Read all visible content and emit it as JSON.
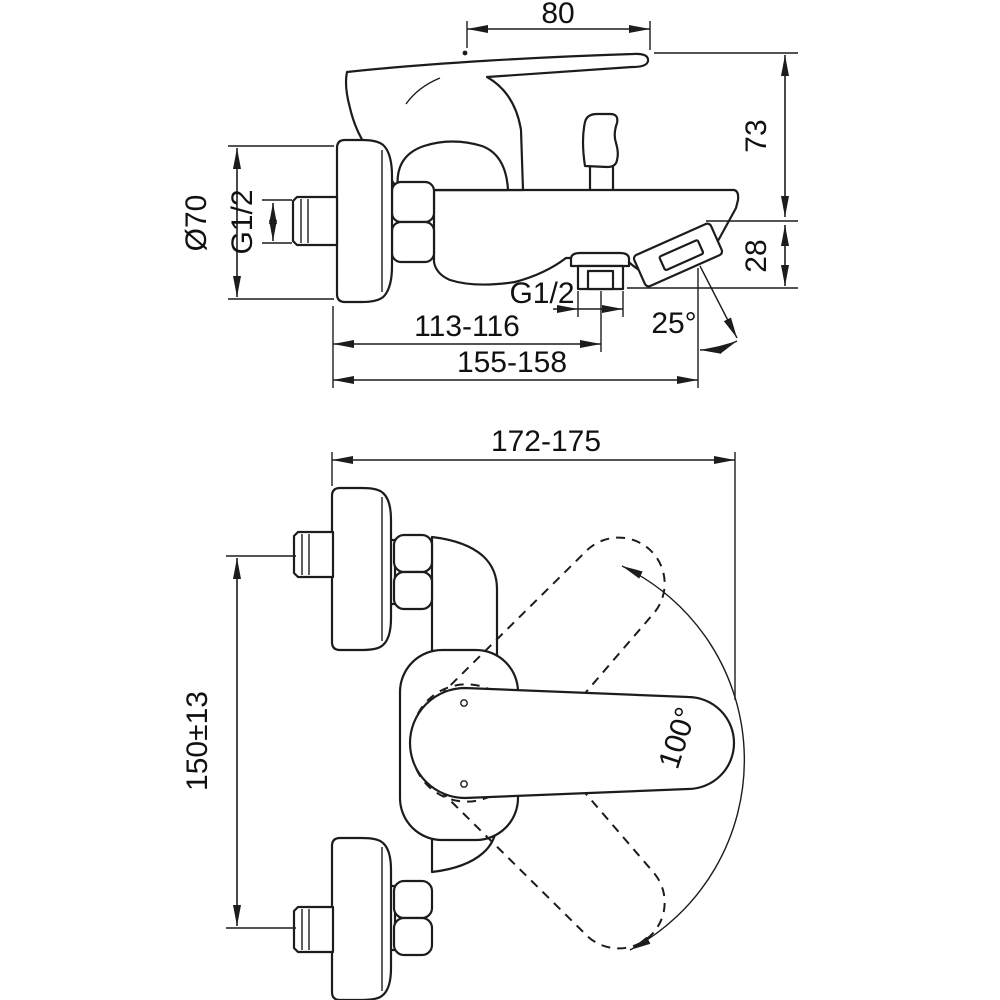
{
  "dimensions": {
    "lever_length": "80",
    "height_to_lever": "73",
    "spout_height": "28",
    "flange_diameter": "Ø70",
    "inlet_thread": "G1/2",
    "hose_outlet_thread": "G1/2",
    "wall_to_hose_outlet": "113-116",
    "wall_to_spout_tip": "155-158",
    "spout_angle": "25°",
    "overall_depth": "172-175",
    "inlet_spacing": "150±13",
    "lever_swing_angle": "100°"
  },
  "colors": {
    "line": "#1c1c1c",
    "background": "#ffffff"
  }
}
